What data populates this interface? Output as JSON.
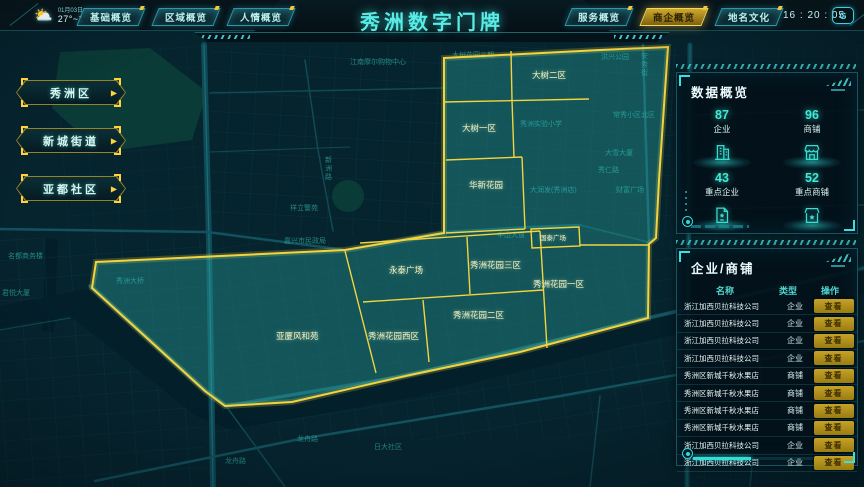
{
  "header": {
    "title": "秀洲数字门牌",
    "date": "01月03日",
    "temperature": "27°~19°",
    "time": "16 : 20 : 05",
    "corner_icon": "G",
    "tabs_left": [
      {
        "label": "基础概览",
        "active": false
      },
      {
        "label": "区域概览",
        "active": false
      },
      {
        "label": "人情概览",
        "active": false
      }
    ],
    "tabs_right": [
      {
        "label": "服务概览",
        "active": false
      },
      {
        "label": "商企概览",
        "active": true
      },
      {
        "label": "地名文化",
        "active": false
      }
    ]
  },
  "left_nav": {
    "arrow_icon": "▶",
    "buttons": [
      {
        "label": "秀洲区"
      },
      {
        "label": "新城街道"
      },
      {
        "label": "亚都社区"
      }
    ]
  },
  "data_overview": {
    "title": "数据概览",
    "stats": [
      {
        "value": "87",
        "label": "企业",
        "icon": "building-icon"
      },
      {
        "value": "96",
        "label": "商铺",
        "icon": "shop-icon"
      },
      {
        "value": "43",
        "label": "重点企业",
        "icon": "key-enterprise-icon"
      },
      {
        "value": "52",
        "label": "重点商铺",
        "icon": "key-shop-icon"
      }
    ]
  },
  "business_panel": {
    "title": "企业/商铺",
    "columns": [
      "名称",
      "类型",
      "操作"
    ],
    "action_label": "查看",
    "rows": [
      {
        "name": "浙江加西贝拉科技公司",
        "type": "企业"
      },
      {
        "name": "浙江加西贝拉科技公司",
        "type": "企业"
      },
      {
        "name": "浙江加西贝拉科技公司",
        "type": "企业"
      },
      {
        "name": "浙江加西贝拉科技公司",
        "type": "企业"
      },
      {
        "name": "秀洲区新城千秋水果店",
        "type": "商铺"
      },
      {
        "name": "秀洲区新城千秋水果店",
        "type": "商铺"
      },
      {
        "name": "秀洲区新城千秋水果店",
        "type": "商铺"
      },
      {
        "name": "秀洲区新城千秋水果店",
        "type": "商铺"
      },
      {
        "name": "浙江加西贝拉科技公司",
        "type": "企业"
      },
      {
        "name": "浙江加西贝拉科技公司",
        "type": "企业"
      }
    ]
  },
  "map": {
    "colors": {
      "highlight_border": "#f3d33f",
      "highlight_fill": "rgba(47,186,178,0.33)",
      "accent": "#35e0d8",
      "base_label": "#2ba39c",
      "region_label": "#eef3c6"
    },
    "region_labels": [
      {
        "text": "大树二区",
        "x": 532,
        "y": 78
      },
      {
        "text": "大树一区",
        "x": 462,
        "y": 131
      },
      {
        "text": "华新花园",
        "x": 469,
        "y": 188
      },
      {
        "text": "国泰广场",
        "x": 540,
        "y": 240,
        "small": true
      },
      {
        "text": "永泰广场",
        "x": 389,
        "y": 273
      },
      {
        "text": "秀洲花园三区",
        "x": 470,
        "y": 268
      },
      {
        "text": "秀洲花园一区",
        "x": 533,
        "y": 287
      },
      {
        "text": "秀洲花园二区",
        "x": 453,
        "y": 318
      },
      {
        "text": "秀洲花园西区",
        "x": 368,
        "y": 339
      },
      {
        "text": "亚厦风和苑",
        "x": 276,
        "y": 339
      }
    ],
    "base_labels": [
      {
        "text": "江南摩尔购物中心",
        "x": 350,
        "y": 64
      },
      {
        "text": "大树花园三期",
        "x": 452,
        "y": 57
      },
      {
        "text": "洪兴公园",
        "x": 601,
        "y": 59
      },
      {
        "text": "安秀街",
        "x": 641,
        "y": 58,
        "vertical": true
      },
      {
        "text": "常秀小区北区",
        "x": 613,
        "y": 117
      },
      {
        "text": "秀洲实验小学",
        "x": 520,
        "y": 126
      },
      {
        "text": "大雪大厦",
        "x": 605,
        "y": 155
      },
      {
        "text": "秀仁路",
        "x": 598,
        "y": 172
      },
      {
        "text": "财富广场",
        "x": 616,
        "y": 192
      },
      {
        "text": "大润发(秀洲店)",
        "x": 530,
        "y": 192
      },
      {
        "text": "中山大道",
        "x": 497,
        "y": 237
      },
      {
        "text": "新洲路",
        "x": 325,
        "y": 162,
        "vertical": true
      },
      {
        "text": "祥立警苑",
        "x": 290,
        "y": 210
      },
      {
        "text": "嘉兴市民政局",
        "x": 284,
        "y": 243
      },
      {
        "text": "秀洲大桥",
        "x": 116,
        "y": 283
      },
      {
        "text": "名都商务楼",
        "x": 8,
        "y": 258
      },
      {
        "text": "君悦大厦",
        "x": 2,
        "y": 295
      },
      {
        "text": "龙舟路",
        "x": 297,
        "y": 441
      },
      {
        "text": "龙舟路",
        "x": 225,
        "y": 463
      },
      {
        "text": "日大社区",
        "x": 374,
        "y": 449
      }
    ]
  }
}
